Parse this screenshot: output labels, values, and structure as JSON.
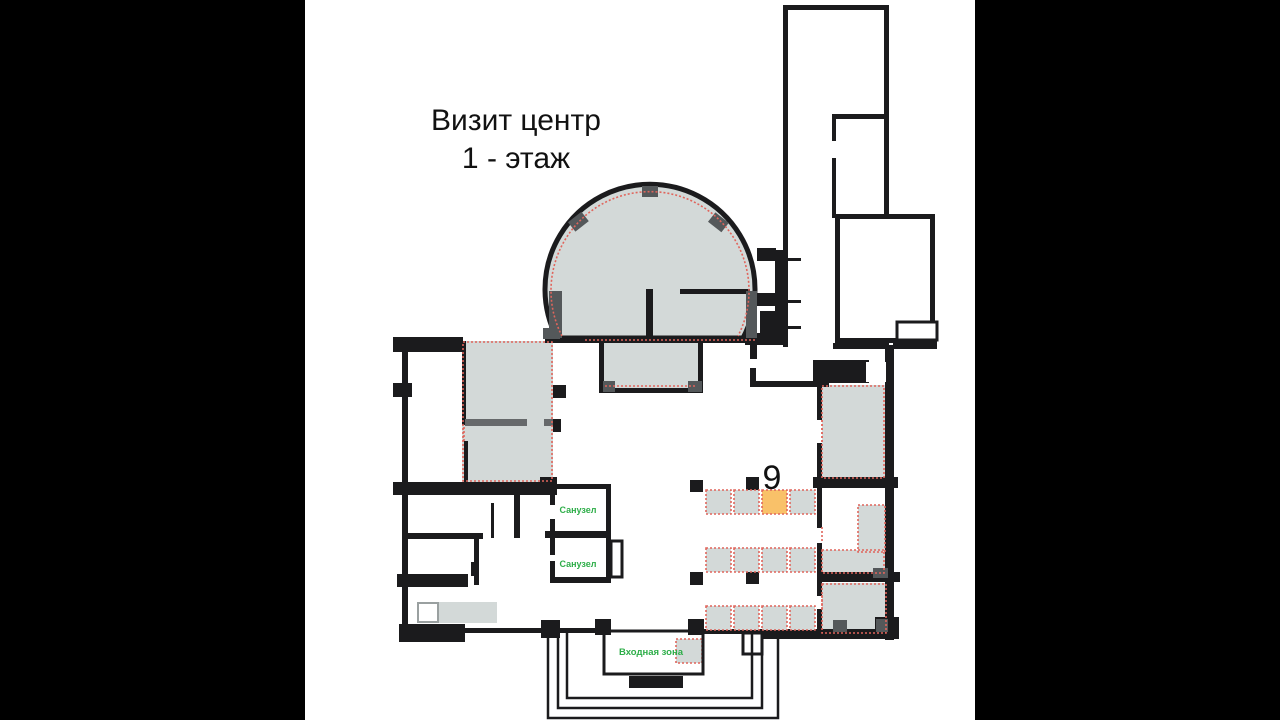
{
  "title": {
    "line1": "Визит центр",
    "line2": "1 - этаж"
  },
  "plan": {
    "room_labels": {
      "toilet_1": "Санузел",
      "toilet_2": "Санузел",
      "entrance": "Входная зона"
    },
    "marker": {
      "number": "9"
    },
    "tables_grid": {
      "rows": 3,
      "cols": 4,
      "highlighted_table": {
        "row": 1,
        "col": 3
      }
    }
  },
  "colors": {
    "letterbox": "#000000",
    "canvas": "#ffffff",
    "wall": "#1b1b1d",
    "room_fill": "#d3d9d8",
    "pillar_dark": "#54585a",
    "divider_gray": "#66696b",
    "dashed_outline": "#e0655c",
    "highlight_fill": "#f9c169",
    "label_green": "#2eae49",
    "title_text": "#111111",
    "bench_box_stroke": "#9aa0a0"
  }
}
